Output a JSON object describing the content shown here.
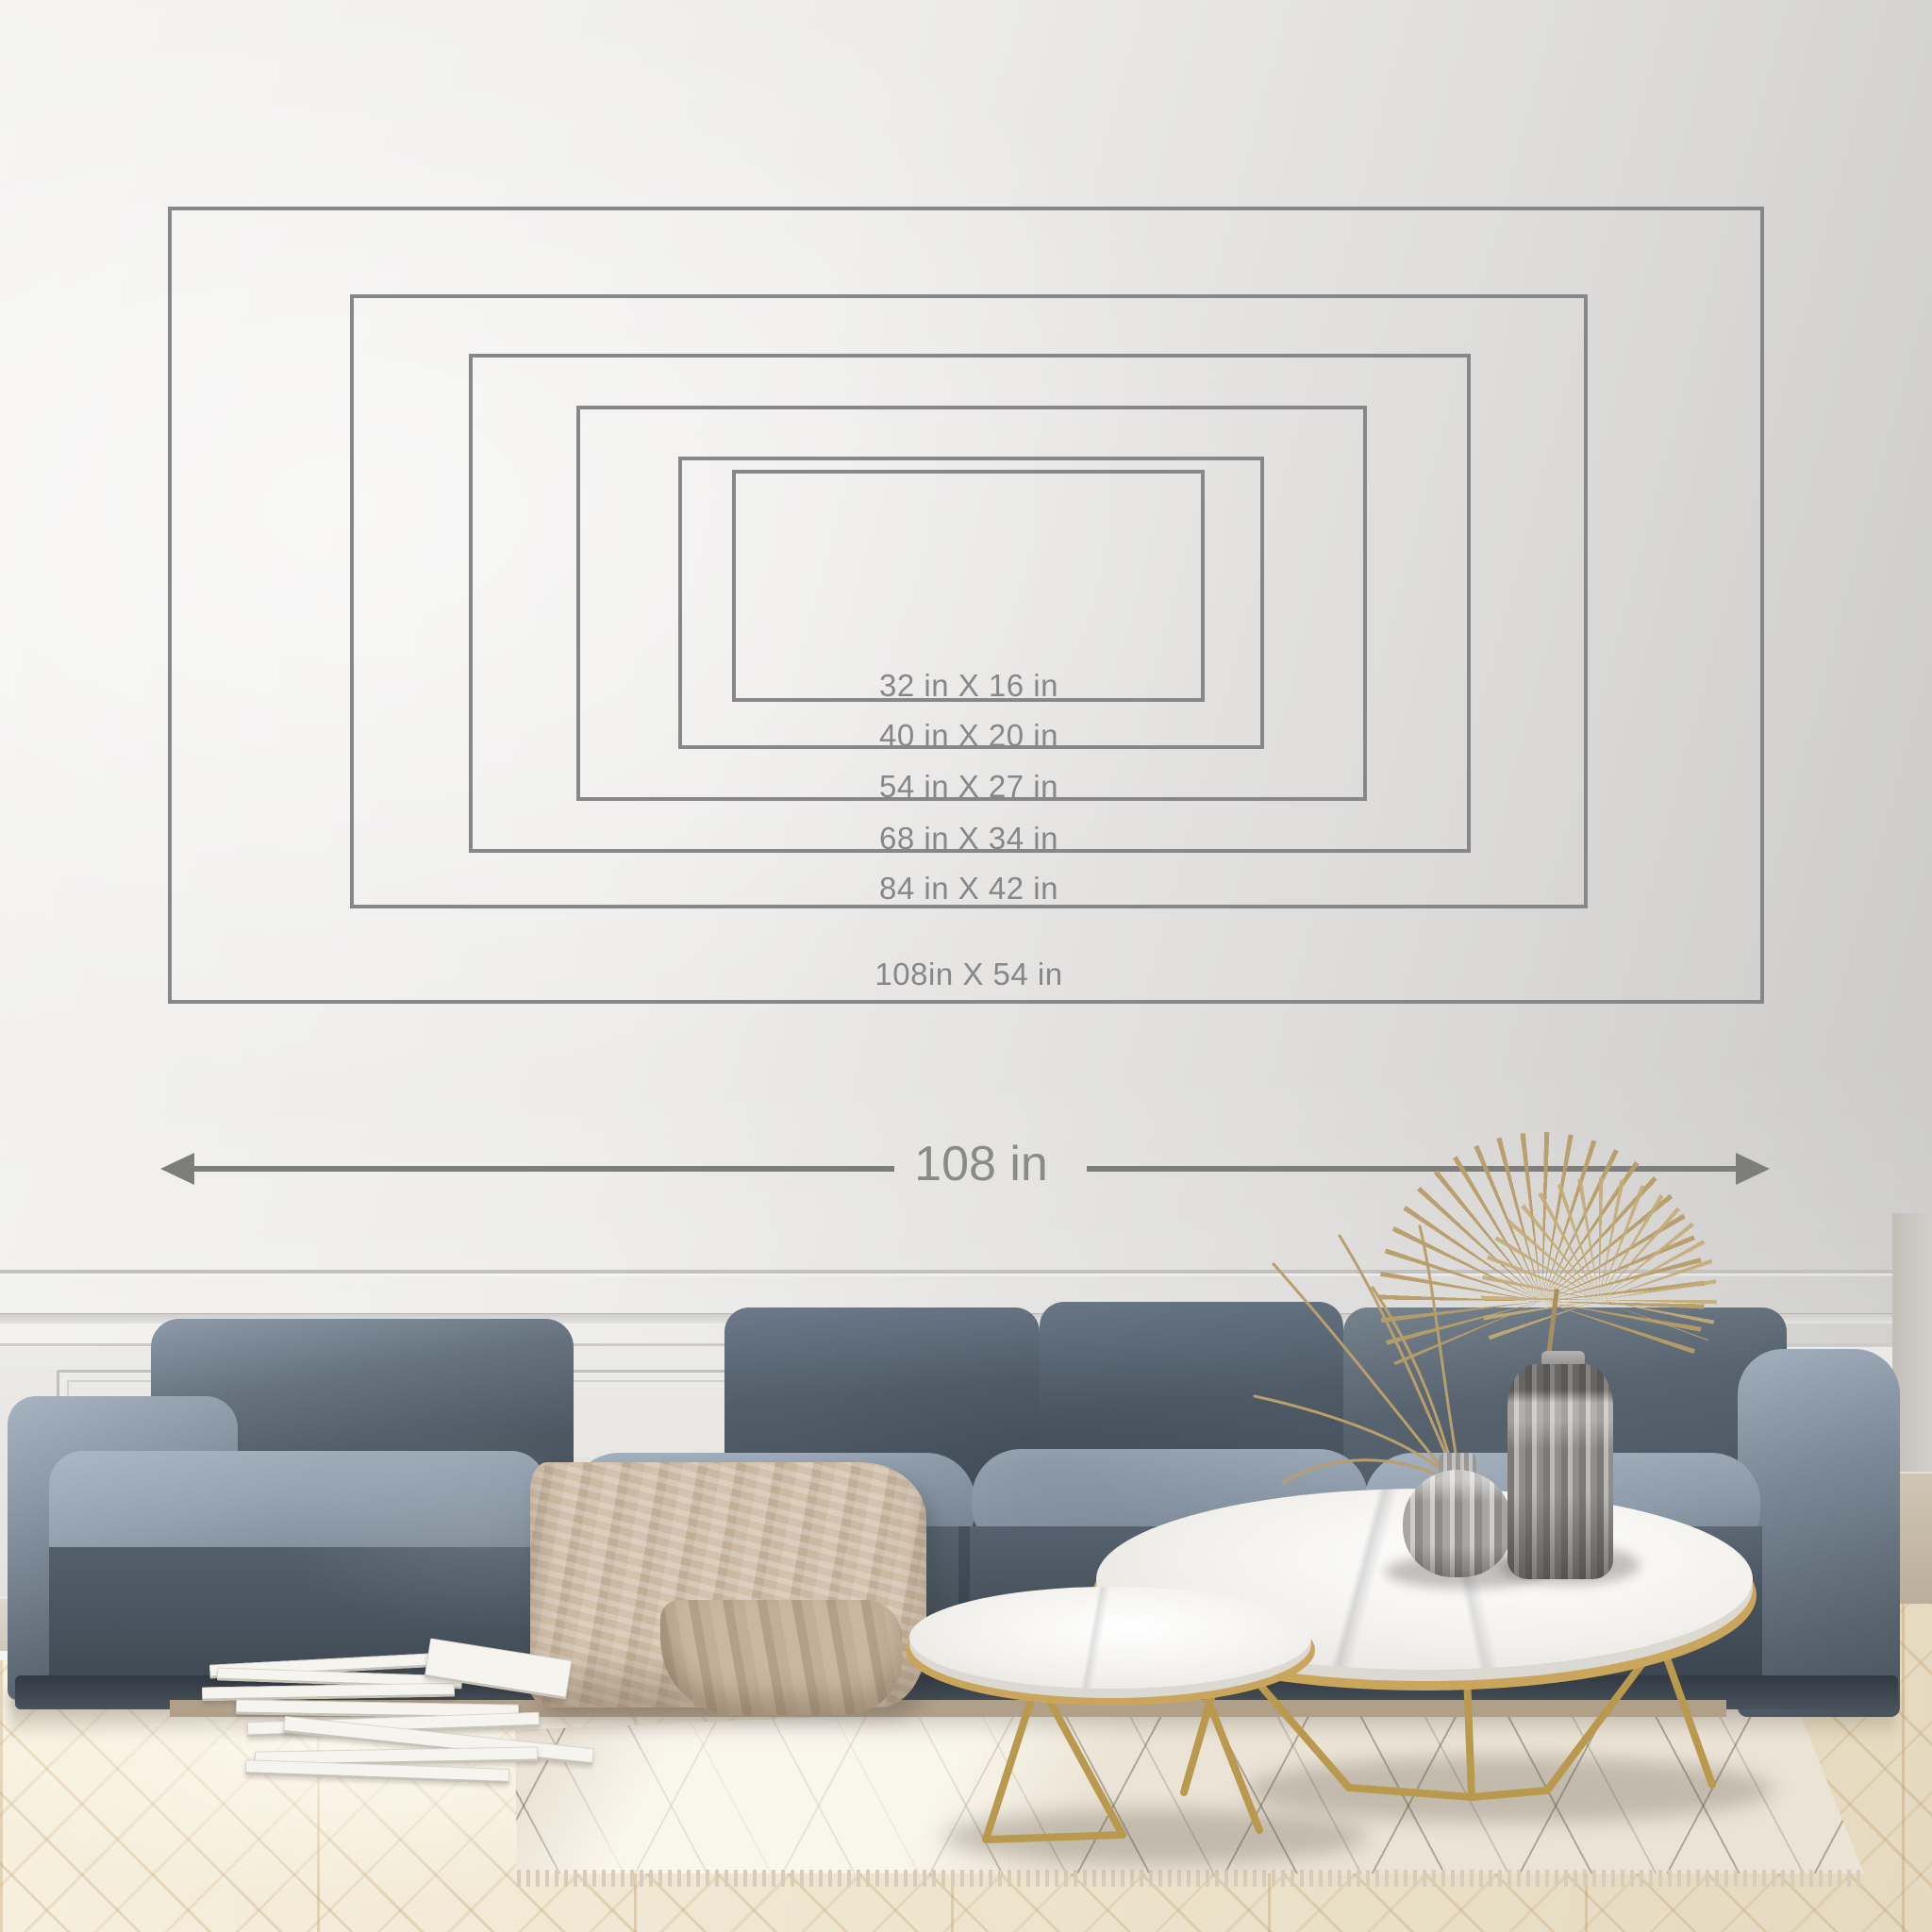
{
  "size_chart": {
    "unit": "in",
    "sizes": [
      {
        "label": "32 in X 16 in",
        "width_in": 32,
        "height_in": 16
      },
      {
        "label": "40 in X 20 in",
        "width_in": 40,
        "height_in": 20
      },
      {
        "label": "54 in X 27 in",
        "width_in": 54,
        "height_in": 27
      },
      {
        "label": "68 in X 34 in",
        "width_in": 68,
        "height_in": 34
      },
      {
        "label": "84 in X 42 in",
        "width_in": 84,
        "height_in": 42
      },
      {
        "label": "108in X 54 in",
        "width_in": 108,
        "height_in": 54
      }
    ],
    "width_arrow": {
      "label": "108 in"
    }
  },
  "colors": {
    "outline_stroke": "#87878a",
    "label_text": "#87878a",
    "arrow": "#7d7d7b",
    "wall_light": "#f4f3f1",
    "wall_dark": "#c8c7c5",
    "sofa_dark": "#46515c",
    "sofa_light": "#9caab8",
    "blanket_beige": "#c9b7a2",
    "table_gold": "#c9a65b",
    "marble_white": "#f2f0ec",
    "floor_cream": "#efe6d2",
    "rug_cream": "#ebe4d6"
  },
  "scene": {
    "setting": "living room wall mockup",
    "objects": [
      "nested size outline rectangles",
      "width arrow",
      "blue velvet modular sofa",
      "knit throw blanket",
      "stacked books",
      "round marble coffee tables with gold legs",
      "ribbed glass vases",
      "dried palm fan",
      "dried grass",
      "herringbone wood floor",
      "berber rug",
      "wainscoting wall panels"
    ]
  }
}
